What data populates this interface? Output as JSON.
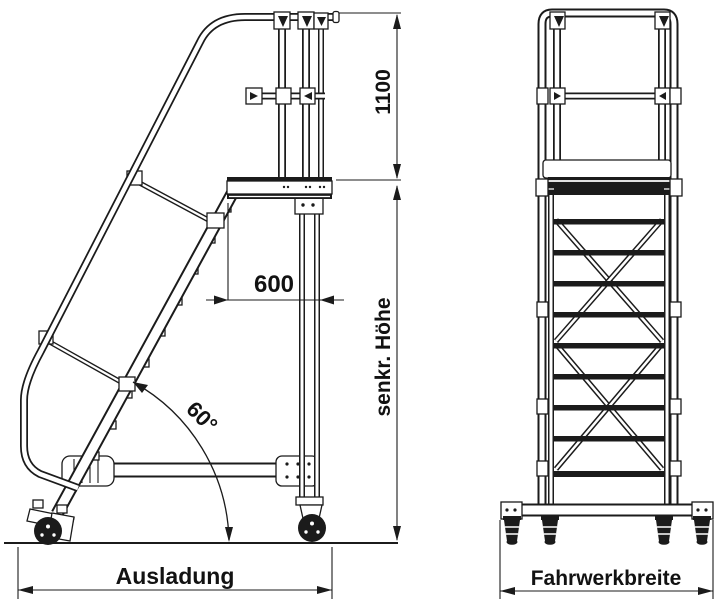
{
  "drawing": {
    "background": "#ffffff",
    "line_color": "#1b1b1b",
    "side_view": {
      "dim_guardrail_height": "1100",
      "dim_platform_depth": "600",
      "dim_angle": "60°",
      "dim_vertical_height": "senkr. Höhe",
      "dim_overhang": "Ausladung"
    },
    "front_view": {
      "dim_chassis_width": "Fahrwerkbreite"
    }
  }
}
